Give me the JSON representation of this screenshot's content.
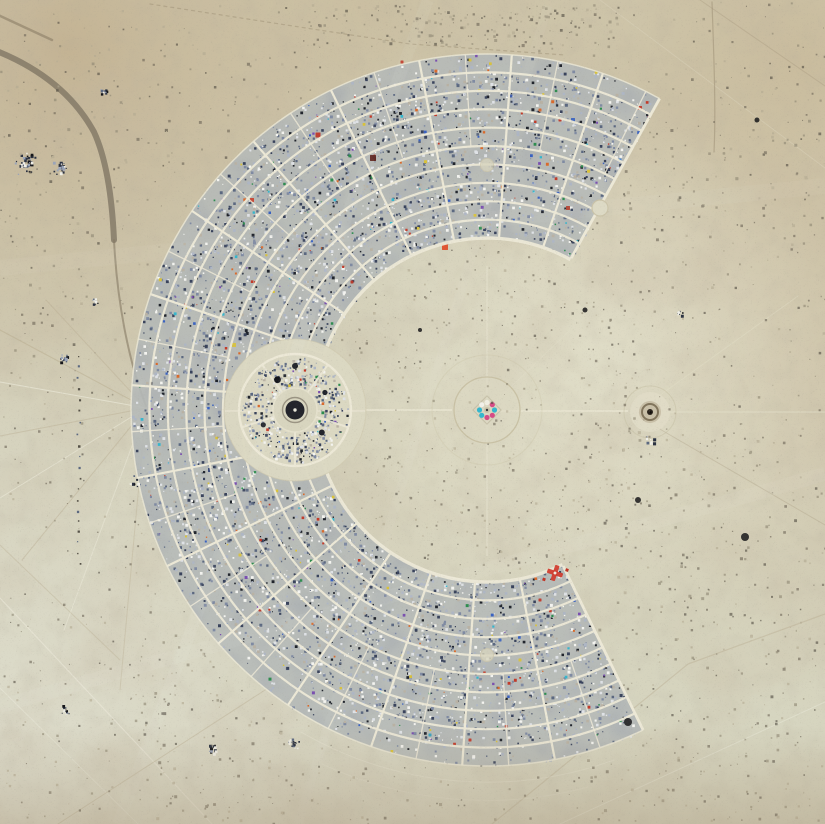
{
  "scene": {
    "description": "Aerial satellite photograph of a C-shaped temporary desert city: thousands of camps arranged in concentric arc blocks around an open playa center with a small central effigy circle, a circular center-camp plaza on the west axis, and a small temple structure east of center, all on pale mottled desert with faint vehicle tracks.",
    "palette": {
      "playa_base": "#d3cfb8",
      "playa_pale": "#deded0",
      "tan_top_left": "#c3b292",
      "tan_top_right": "#c9bb9c",
      "halo_gap": "#e4e2ce",
      "street": "#ece8d6",
      "camp_base": "#b6bab8",
      "dark_road": "#7b7260",
      "bottom_strip": "#a8977b",
      "man_cyan": "#35b6cd",
      "man_pink": "#d64b86",
      "red_camp": "#d0392b"
    },
    "city": {
      "cx": 487,
      "cy": 410,
      "inner_radius": 172,
      "outer_radius": 356,
      "ring_streets": 11,
      "arc_start_deg": 64,
      "arc_end_deg": 299,
      "radial_step_deg": 15,
      "half_radial_from_r": 264,
      "street_color": "#ece8d6"
    },
    "landmarks": {
      "the_man": {
        "label": "central effigy circle",
        "transform": "translate(487,410)"
      },
      "center_camp": {
        "label": "center camp circle",
        "transform": "translate(295,410)",
        "cx": 295,
        "cy": 410,
        "clearing_r": 71,
        "ring_r": 56,
        "plaza_r": 22
      },
      "temple": {
        "label": "temple structure",
        "transform": "translate(650,412)"
      },
      "plaza_top": {
        "cx": 600,
        "cy": 208,
        "r": 8
      },
      "plaza_north": {
        "cx": 487,
        "cy": 165,
        "r": 6.5
      },
      "plaza_south": {
        "cx": 487,
        "cy": 655,
        "r": 6.5
      },
      "red_cross_camp": {
        "transform": "translate(555,573) rotate(18)",
        "color": "#d0392b"
      }
    }
  },
  "render": {
    "seed": 1337,
    "camp_speckles": {
      "count": 7200,
      "min_size": 0.9,
      "max_size": 3.0
    },
    "camp_palette": [
      [
        "#f4f4f0",
        14
      ],
      [
        "#dfe2e6",
        12
      ],
      [
        "#aeb6c4",
        16
      ],
      [
        "#7f8aa2",
        16
      ],
      [
        "#5b6880",
        10
      ],
      [
        "#39435c",
        10
      ],
      [
        "#20242c",
        8
      ],
      [
        "#b9b2a4",
        9
      ],
      [
        "ACCENT",
        5
      ]
    ],
    "accent_colors": [
      "#c23b2a",
      "#d96a2c",
      "#d9c23a",
      "#3a62c0",
      "#35b6cd",
      "#7a4fb0",
      "#2e8c4f"
    ],
    "playa_speckles": {
      "count": 1500
    },
    "playa_palette": [
      [
        "#8d8672",
        34
      ],
      [
        "#6b6355",
        26
      ],
      [
        "#4f4a40",
        15
      ],
      [
        "#b3aa92",
        25
      ]
    ],
    "cluster_palette": [
      [
        "#2b3242",
        30
      ],
      [
        "#f0efe8",
        22
      ],
      [
        "#5b6880",
        22
      ],
      [
        "#15161a",
        12
      ],
      [
        "#9aa4b8",
        14
      ]
    ],
    "inner_playa_speckles": {
      "count": 240
    },
    "center_camp_speckles": {
      "count": 520
    },
    "bands": [
      {
        "x0": 300,
        "x1": 620,
        "y0": 4,
        "y1": 46,
        "count": 170
      },
      {
        "x0": 560,
        "x1": 820,
        "y0": 430,
        "y1": 820,
        "count": 260
      },
      {
        "x0": 620,
        "x1": 820,
        "y0": 60,
        "y1": 240,
        "count": 80
      },
      {
        "x0": 0,
        "x1": 250,
        "y0": 40,
        "y1": 360,
        "count": 120
      },
      {
        "x0": 140,
        "x1": 470,
        "y0": 620,
        "y1": 820,
        "count": 150
      }
    ],
    "clusters": [
      {
        "x": 25,
        "y": 163,
        "count": 40,
        "spread": 14
      },
      {
        "x": 60,
        "y": 168,
        "count": 25,
        "spread": 10
      },
      {
        "x": 103,
        "y": 90,
        "count": 12,
        "spread": 6
      },
      {
        "x": 63,
        "y": 358,
        "count": 14,
        "spread": 7
      },
      {
        "x": 292,
        "y": 744,
        "count": 18,
        "spread": 9
      },
      {
        "x": 65,
        "y": 710,
        "count": 16,
        "spread": 8
      },
      {
        "x": 212,
        "y": 748,
        "count": 12,
        "spread": 7
      },
      {
        "x": 95,
        "y": 300,
        "count": 10,
        "spread": 6
      },
      {
        "x": 135,
        "y": 480,
        "count": 10,
        "spread": 12
      },
      {
        "x": 680,
        "y": 312,
        "count": 8,
        "spread": 5
      },
      {
        "x": 650,
        "y": 440,
        "count": 8,
        "spread": 6
      }
    ],
    "accent_camps": [
      {
        "x": 318,
        "y": 135,
        "c": "#c03526",
        "s": 5
      },
      {
        "x": 373,
        "y": 158,
        "c": "#5a2018",
        "s": 6
      },
      {
        "x": 252,
        "y": 200,
        "c": "#c8402e",
        "s": 4
      },
      {
        "x": 445,
        "y": 247,
        "c": "#e04b28",
        "s": 6
      },
      {
        "x": 640,
        "y": 108,
        "c": "#c03526",
        "s": 4
      },
      {
        "x": 573,
        "y": 120,
        "c": "#3a62c0",
        "s": 4
      },
      {
        "x": 234,
        "y": 345,
        "c": "#d9c23a",
        "s": 4
      },
      {
        "x": 568,
        "y": 208,
        "c": "#b23a2a",
        "s": 4
      },
      {
        "x": 540,
        "y": 110,
        "c": "#d9682c",
        "s": 3
      },
      {
        "x": 300,
        "y": 250,
        "c": "#c8402e",
        "s": 3
      },
      {
        "x": 210,
        "y": 470,
        "c": "#2e3f73",
        "s": 4
      },
      {
        "x": 260,
        "y": 610,
        "c": "#c03526",
        "s": 3
      },
      {
        "x": 380,
        "y": 690,
        "c": "#3a62c0",
        "s": 3
      },
      {
        "x": 470,
        "y": 740,
        "c": "#c03526",
        "s": 3
      },
      {
        "x": 520,
        "y": 660,
        "c": "#d9c23a",
        "s": 3
      },
      {
        "x": 540,
        "y": 600,
        "c": "#c03526",
        "s": 3
      },
      {
        "x": 500,
        "y": 640,
        "c": "#3a62c0",
        "s": 3
      },
      {
        "x": 560,
        "y": 120,
        "c": "#c03526",
        "s": 3
      },
      {
        "x": 511,
        "y": 96,
        "c": "#3556a8",
        "s": 3
      },
      {
        "x": 402,
        "y": 62,
        "c": "#c03526",
        "s": 3
      },
      {
        "x": 470,
        "y": 60,
        "c": "#d9c23a",
        "s": 3
      },
      {
        "x": 620,
        "y": 160,
        "c": "#3a7fd9",
        "s": 3
      },
      {
        "x": 352,
        "y": 282,
        "c": "#c03526",
        "s": 3
      },
      {
        "x": 240,
        "y": 555,
        "c": "#d9c23a",
        "s": 3
      },
      {
        "x": 430,
        "y": 735,
        "c": "#2f9fbf",
        "s": 3
      }
    ],
    "playa_marks": [
      {
        "x": 745,
        "y": 537,
        "s": 4
      },
      {
        "x": 638,
        "y": 500,
        "s": 3
      },
      {
        "x": 628,
        "y": 722,
        "s": 4
      },
      {
        "x": 585,
        "y": 310,
        "s": 2.5
      },
      {
        "x": 757,
        "y": 120,
        "s": 2.5
      },
      {
        "x": 420,
        "y": 330,
        "s": 2
      }
    ],
    "fence_dots": {
      "x": 78,
      "y0": 356,
      "y1": 566,
      "step": 9
    }
  }
}
